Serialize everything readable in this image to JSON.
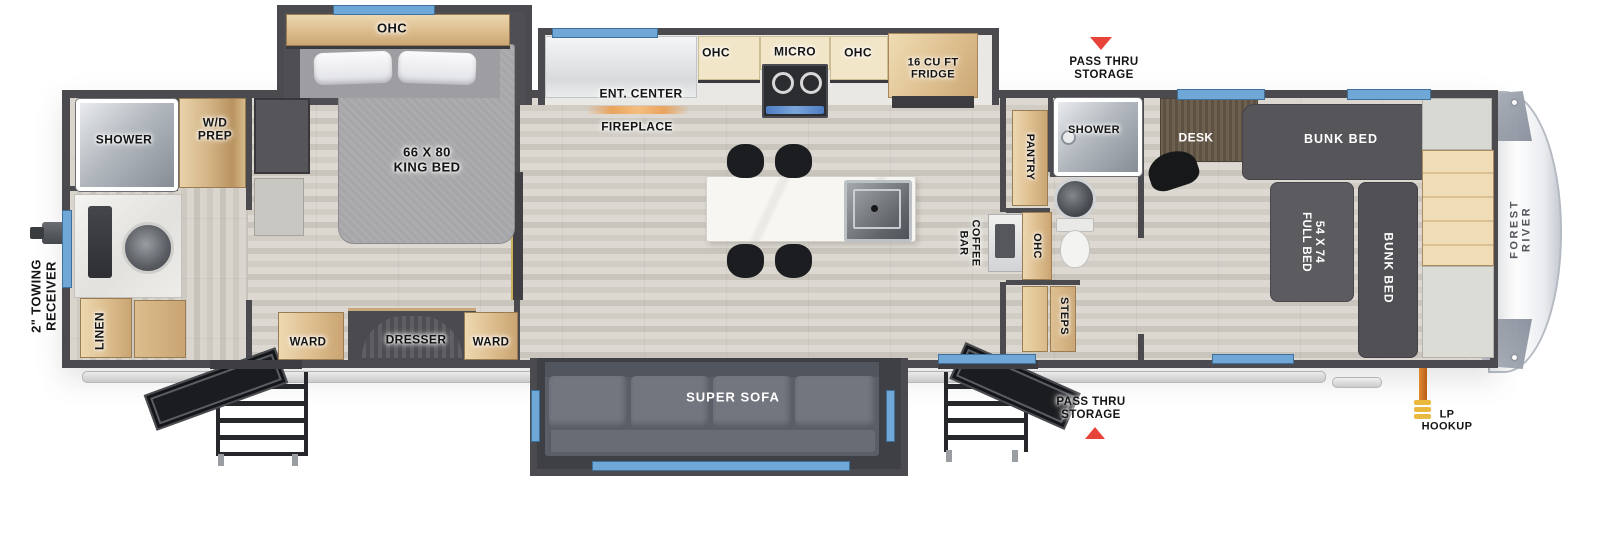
{
  "colors": {
    "wall": "#4a4a4f",
    "window": "#6fa8d6",
    "red": "#e8433a",
    "lp_orange": "#cd6a1f",
    "lp_yellow": "#e9b83d",
    "wood": "#ddbd8d",
    "dark_furniture": "#55555a",
    "floor": "#d6d2cb",
    "cap_white": "#f7f8fa"
  },
  "exterior": {
    "brand": "FOREST RIVER",
    "towing_receiver": "2\" TOWING\nRECEIVER",
    "pass_thru_top": "PASS THRU\nSTORAGE",
    "pass_thru_bottom": "PASS THRU\nSTORAGE",
    "lp_hookup": "LP\nHOOKUP"
  },
  "rear_bath": {
    "shower": "SHOWER",
    "wd_prep": "W/D\nPREP",
    "linen": "LINEN"
  },
  "bedroom": {
    "ohc": "OHC",
    "king_bed": "66 X 80\nKING BED",
    "ward_left": "WARD",
    "dresser": "DRESSER",
    "ward_right": "WARD"
  },
  "kitchen": {
    "ent_center": "ENT. CENTER",
    "fireplace": "FIREPLACE",
    "ohc_left": "OHC",
    "micro": "MICRO",
    "ohc_right": "OHC",
    "fridge": "16 CU FT\nFRIDGE",
    "coffee_bar": "COFFEE\nBAR",
    "super_sofa": "SUPER SOFA"
  },
  "mid_bath": {
    "pantry": "PANTRY",
    "shower": "SHOWER",
    "ohc": "OHC",
    "steps": "STEPS"
  },
  "bunk_room": {
    "desk": "DESK",
    "bunk_bed_top": "BUNK BED",
    "full_bed": "54 X 74\nFULL BED",
    "bunk_bed_side": "BUNK BED"
  }
}
